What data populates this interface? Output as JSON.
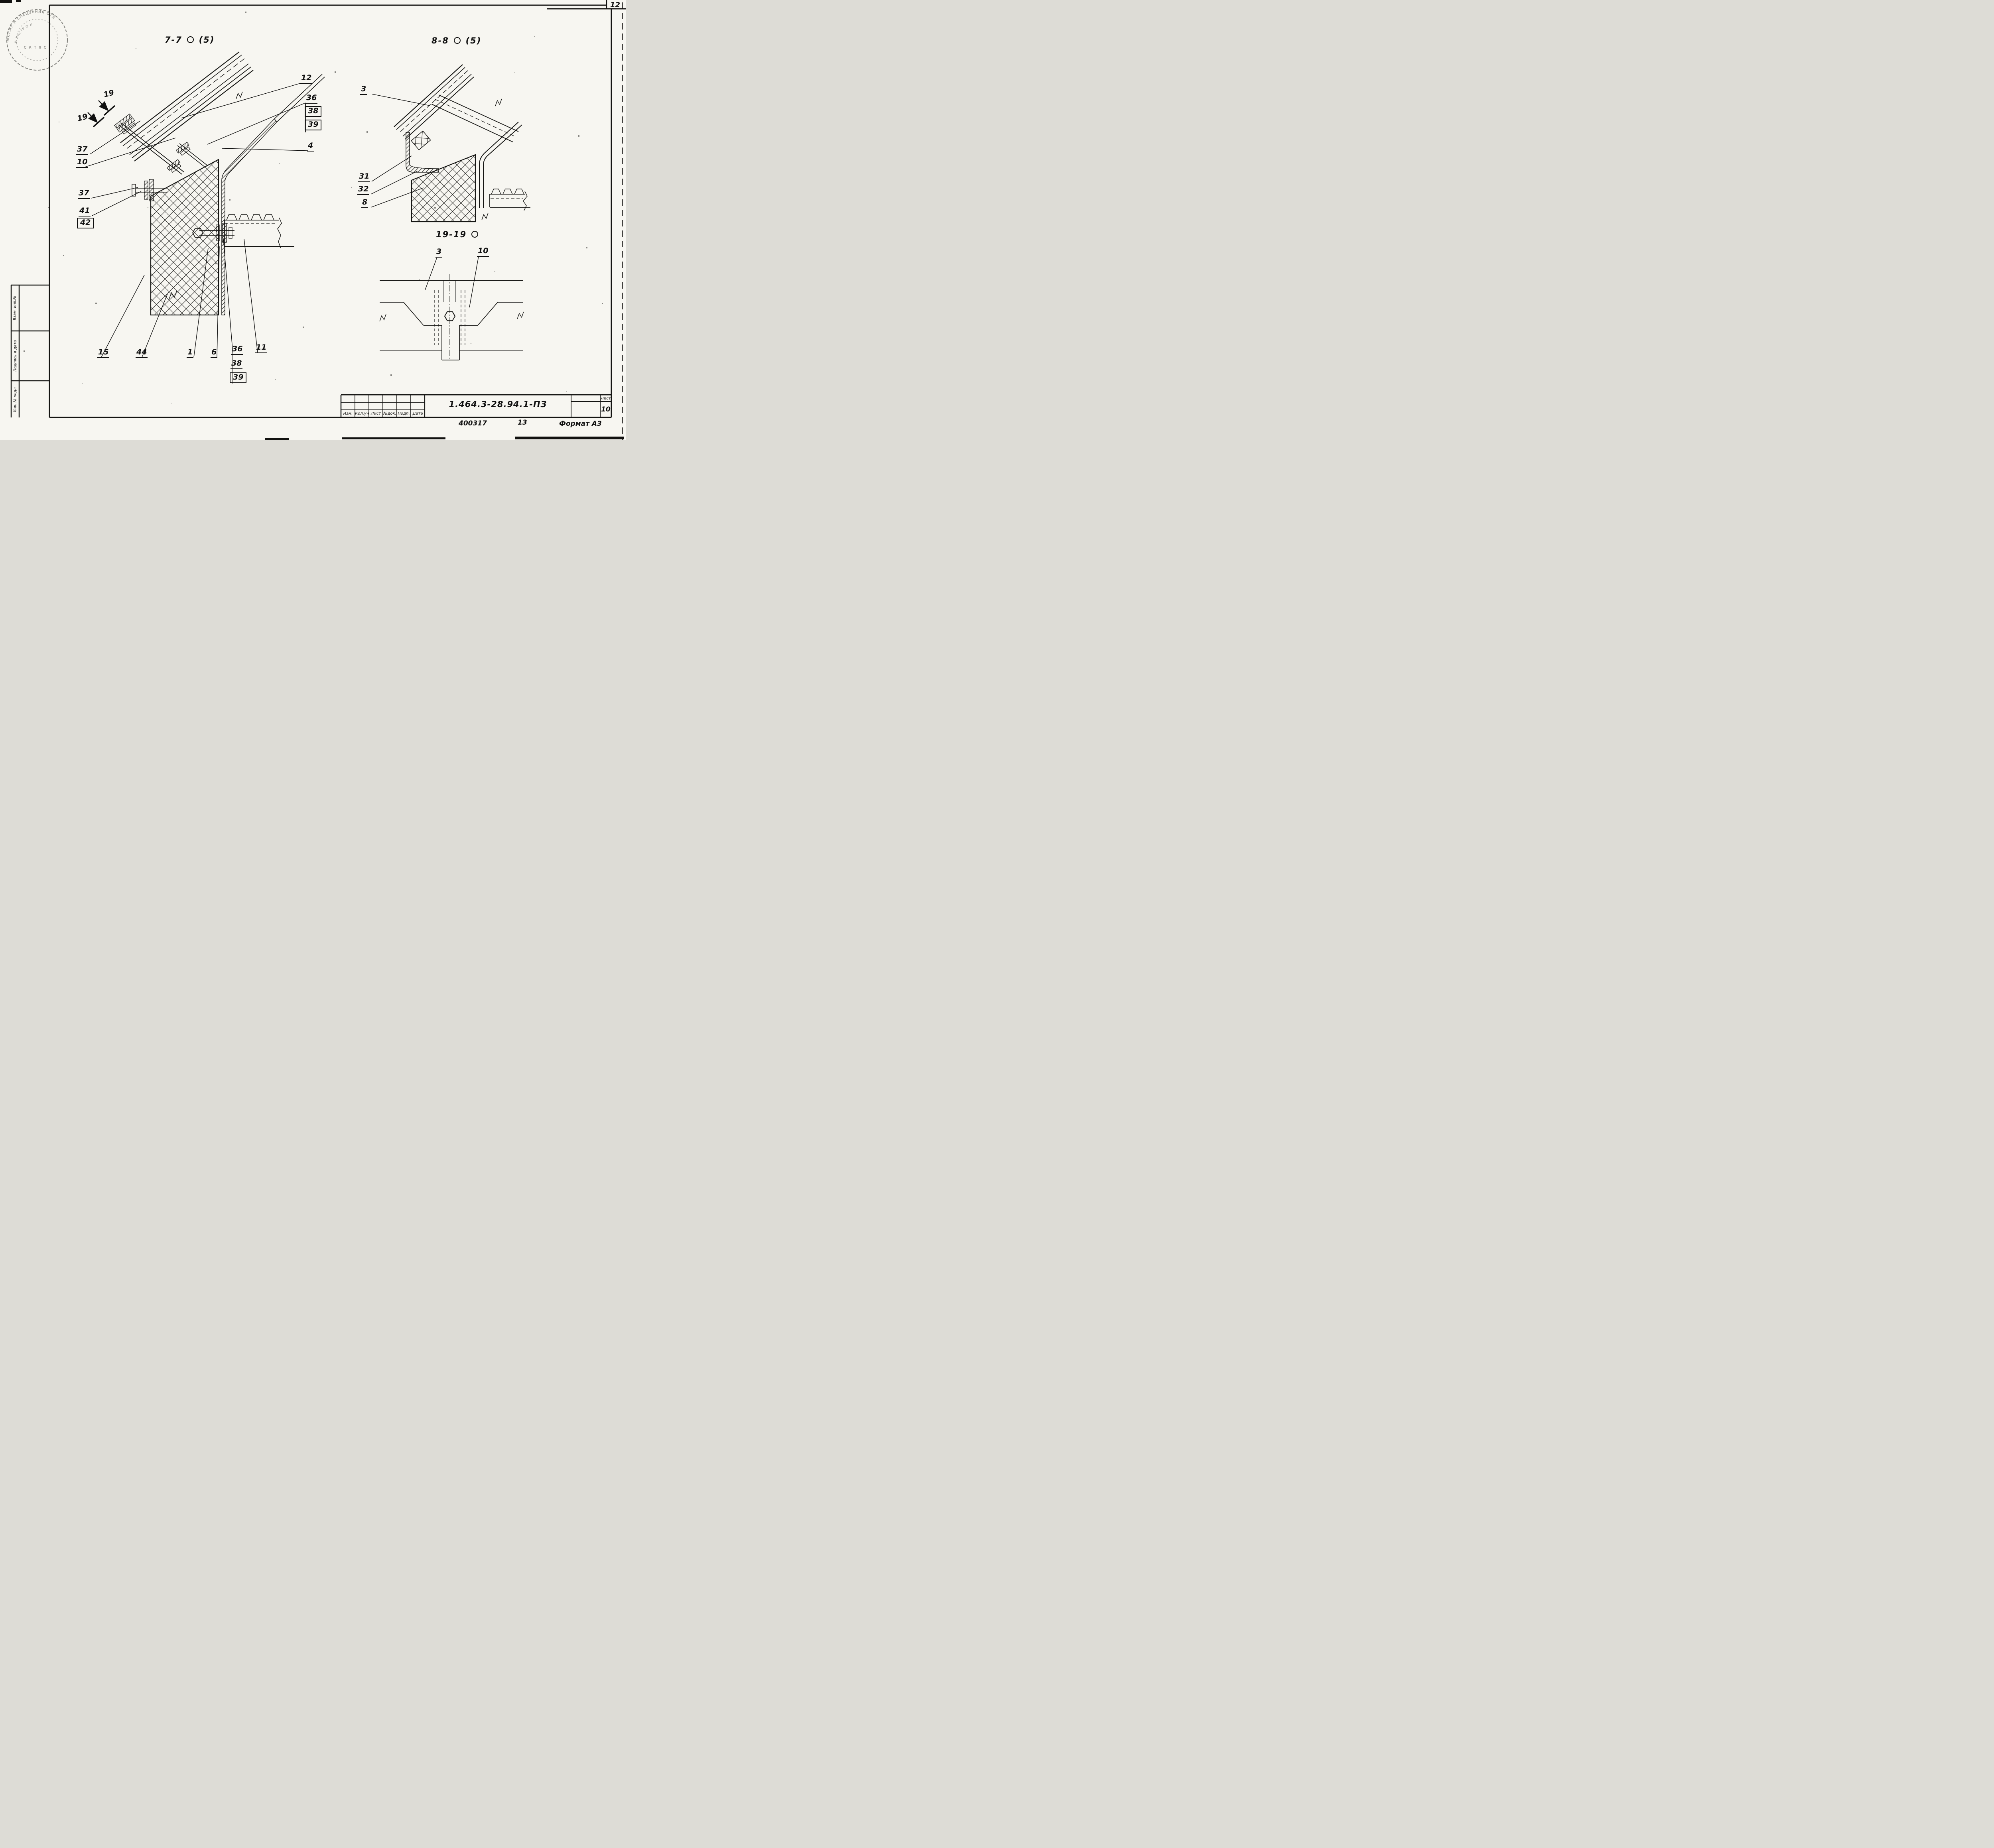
{
  "sheet": {
    "corner_number": "12",
    "order_number": "400317",
    "adjacent_sheet": "13",
    "format_note": "Формат А3"
  },
  "sections": {
    "s77": {
      "name": "7-7",
      "scale_ref": "(5)"
    },
    "s88": {
      "name": "8-8",
      "scale_ref": "(5)"
    },
    "s1919": {
      "name": "19-19"
    }
  },
  "cut_markers": {
    "first": "19",
    "second": "19"
  },
  "callouts": {
    "d77": {
      "p12": "12",
      "p36": "36",
      "p38": "38",
      "p39": "39",
      "p4": "4",
      "p37a": "37",
      "p10": "10",
      "p37b": "37",
      "p41": "41",
      "p42": "42",
      "p15": "15",
      "p44": "44",
      "p1": "1",
      "p6": "6",
      "p36b": "36",
      "p38b": "38",
      "p39b": "39",
      "p11": "11"
    },
    "d88": {
      "p3": "3",
      "p31": "31",
      "p32": "32",
      "p8": "8"
    },
    "d1919": {
      "p3": "3",
      "p10": "10"
    }
  },
  "sidebar": {
    "cells": [
      "Взам. инв.№",
      "Подпись и дата",
      "Инв. № подл."
    ]
  },
  "title_block": {
    "headers": [
      "Изм.",
      "Кол.уч",
      "Лист",
      "№док.",
      "Подп.",
      "Дата"
    ],
    "doc_number": "1.464.3-28.94.1-ПЗ",
    "sheet_label": "Лист",
    "sheet_number": "10"
  },
  "stamp": {
    "illegible": true,
    "arc_fragments": {
      "outer": "ЖСКИХ И СПЕЦЗАНИЯ ОТД",
      "inner": "Й ИНСТР  О К",
      "line": "С К Т Я  С"
    }
  }
}
